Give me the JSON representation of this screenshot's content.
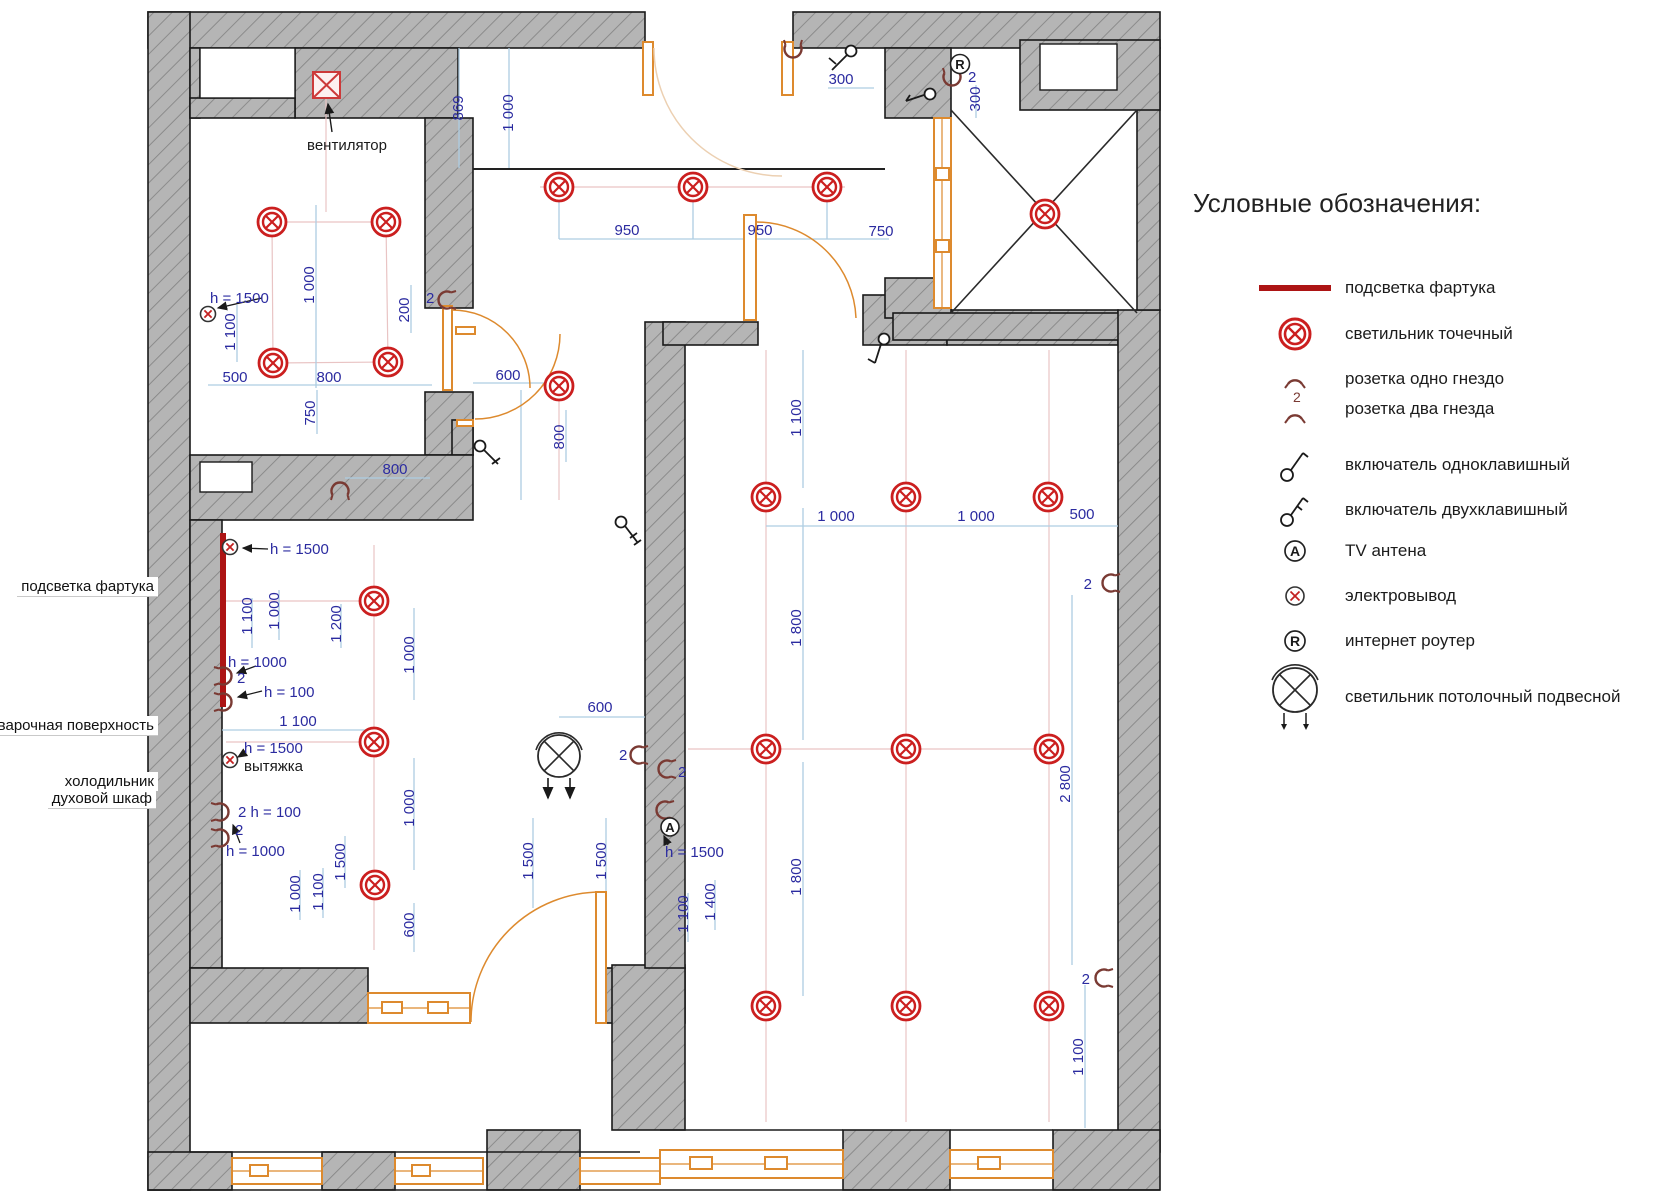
{
  "legend": {
    "title": "Условные обозначения:",
    "tv_glyph": "A",
    "router_glyph": "R",
    "socket2_badge": "2",
    "items": [
      {
        "icon": "backsplash-line-icon",
        "label": "подсветка фартука"
      },
      {
        "icon": "spotlight-icon",
        "label": "светильник точечный"
      },
      {
        "icon": "socket-single-icon",
        "label": "розетка одно гнездо"
      },
      {
        "icon": "socket-double-icon",
        "label": "розетка два гнезда"
      },
      {
        "icon": "switch-one-key-icon",
        "label": "включатель одноклавишный"
      },
      {
        "icon": "switch-two-key-icon",
        "label": "включатель двухклавишный"
      },
      {
        "icon": "tv-antenna-icon",
        "label": "TV антена"
      },
      {
        "icon": "electro-output-icon",
        "label": "электровывод"
      },
      {
        "icon": "internet-router-icon",
        "label": "интернет роутер"
      },
      {
        "icon": "pendant-light-icon",
        "label": "светильник потолочный подвесной"
      }
    ]
  },
  "plan": {
    "labels": {
      "fan": "вентилятор",
      "backsplash": "подсветка фартука",
      "hob": "варочная поверхность",
      "fridge": "холодильник",
      "oven": "духовой шкаф",
      "hood": "вытяжка"
    },
    "glyphs": {
      "tv": "A",
      "router": "R"
    },
    "dims": {
      "d_869": "869",
      "d_1000_corr": "1 000",
      "bath_1000": "1 000",
      "bath_200": "200",
      "bath_2": "2",
      "bath_h1500": "h = 1500",
      "bath_1100": "1 100",
      "bath_500": "500",
      "bath_800a": "800",
      "bath_750": "750",
      "bath_800b": "800",
      "corr_950a": "950",
      "corr_950b": "950",
      "corr_750": "750",
      "corr_300a": "300",
      "corr_300b": "300",
      "corr_2": "2",
      "hall_600": "600",
      "hall_800": "800",
      "kit_h1500a": "h = 1500",
      "kit_1100a": "1 100",
      "kit_1000a": "1 000",
      "kit_1200": "1 200",
      "kit_h1000a": "h = 1000",
      "kit_2a": "2",
      "kit_h100": "h = 100",
      "kit_1100b": "1 100",
      "kit_h1500b": "h = 1500",
      "kit_2h100": "2 h = 100",
      "kit_2b": "2",
      "kit_h1000b": "h = 1000",
      "kit_1000b": "1 000",
      "kit_1100c": "1 100",
      "kit_1500a": "1 500",
      "kit_1000c": "1 000",
      "kit_1000d": "1 000",
      "kit_600a": "600",
      "kit_600b": "600",
      "kit_1500b": "1 500",
      "kit_1500c": "1 500",
      "kit_2c": "2",
      "kit_2d": "2",
      "kit_h1500c": "h = 1500",
      "kit_1100d": "1 100",
      "kit_1400": "1 400",
      "liv_1100a": "1 100",
      "liv_1000a": "1 000",
      "liv_1000b": "1 000",
      "liv_500": "500",
      "liv_1800a": "1 800",
      "liv_1800b": "1 800",
      "liv_2800": "2 800",
      "liv_1100b": "1 100",
      "liv_2a": "2",
      "liv_2b": "2"
    }
  }
}
